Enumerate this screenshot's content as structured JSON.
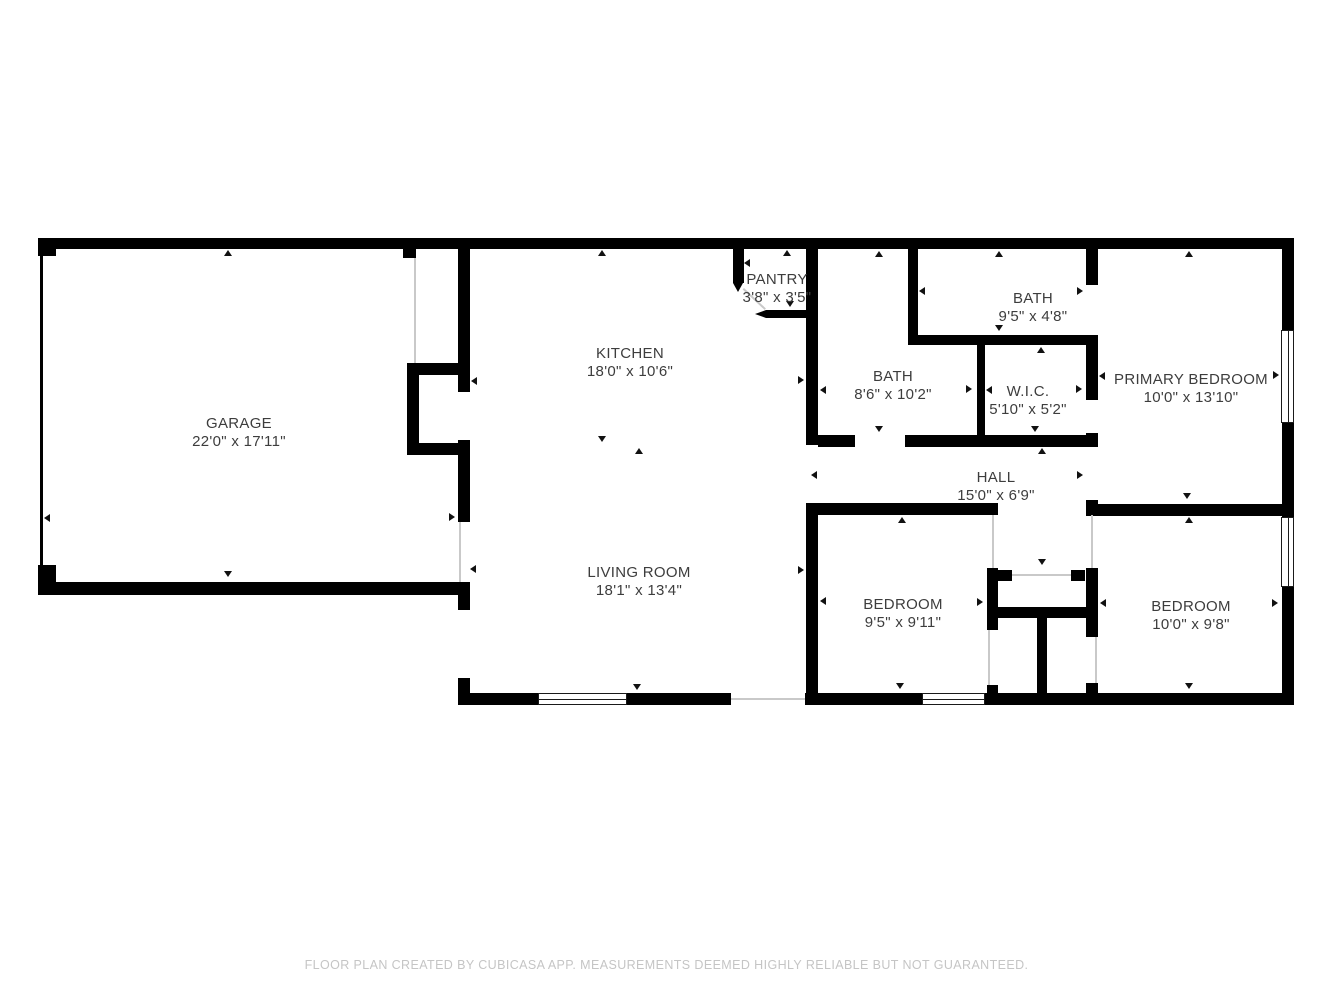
{
  "rooms": {
    "garage": {
      "name": "GARAGE",
      "dims": "22'0\" x 17'11\""
    },
    "kitchen": {
      "name": "KITCHEN",
      "dims": "18'0\" x 10'6\""
    },
    "pantry": {
      "name": "PANTRY",
      "dims": "3'8\" x 3'5\""
    },
    "bath1": {
      "name": "BATH",
      "dims": "8'6\" x 10'2\""
    },
    "bath2": {
      "name": "BATH",
      "dims": "9'5\" x 4'8\""
    },
    "wic": {
      "name": "W.I.C.",
      "dims": "5'10\" x 5'2\""
    },
    "primary": {
      "name": "PRIMARY BEDROOM",
      "dims": "10'0\" x 13'10\""
    },
    "hall": {
      "name": "HALL",
      "dims": "15'0\" x 6'9\""
    },
    "living": {
      "name": "LIVING ROOM",
      "dims": "18'1\" x 13'4\""
    },
    "bedroom1": {
      "name": "BEDROOM",
      "dims": "9'5\" x 9'11\""
    },
    "bedroom2": {
      "name": "BEDROOM",
      "dims": "10'0\" x 9'8\""
    }
  },
  "footer": "FLOOR PLAN CREATED BY CUBICASA APP. MEASUREMENTS DEEMED HIGHLY RELIABLE BUT NOT GUARANTEED.",
  "colors": {
    "wall": "#000000",
    "label": "#3d3d3d",
    "footer_text": "#c5c5c5",
    "background": "#ffffff",
    "opening_line": "#c9c9c9"
  }
}
